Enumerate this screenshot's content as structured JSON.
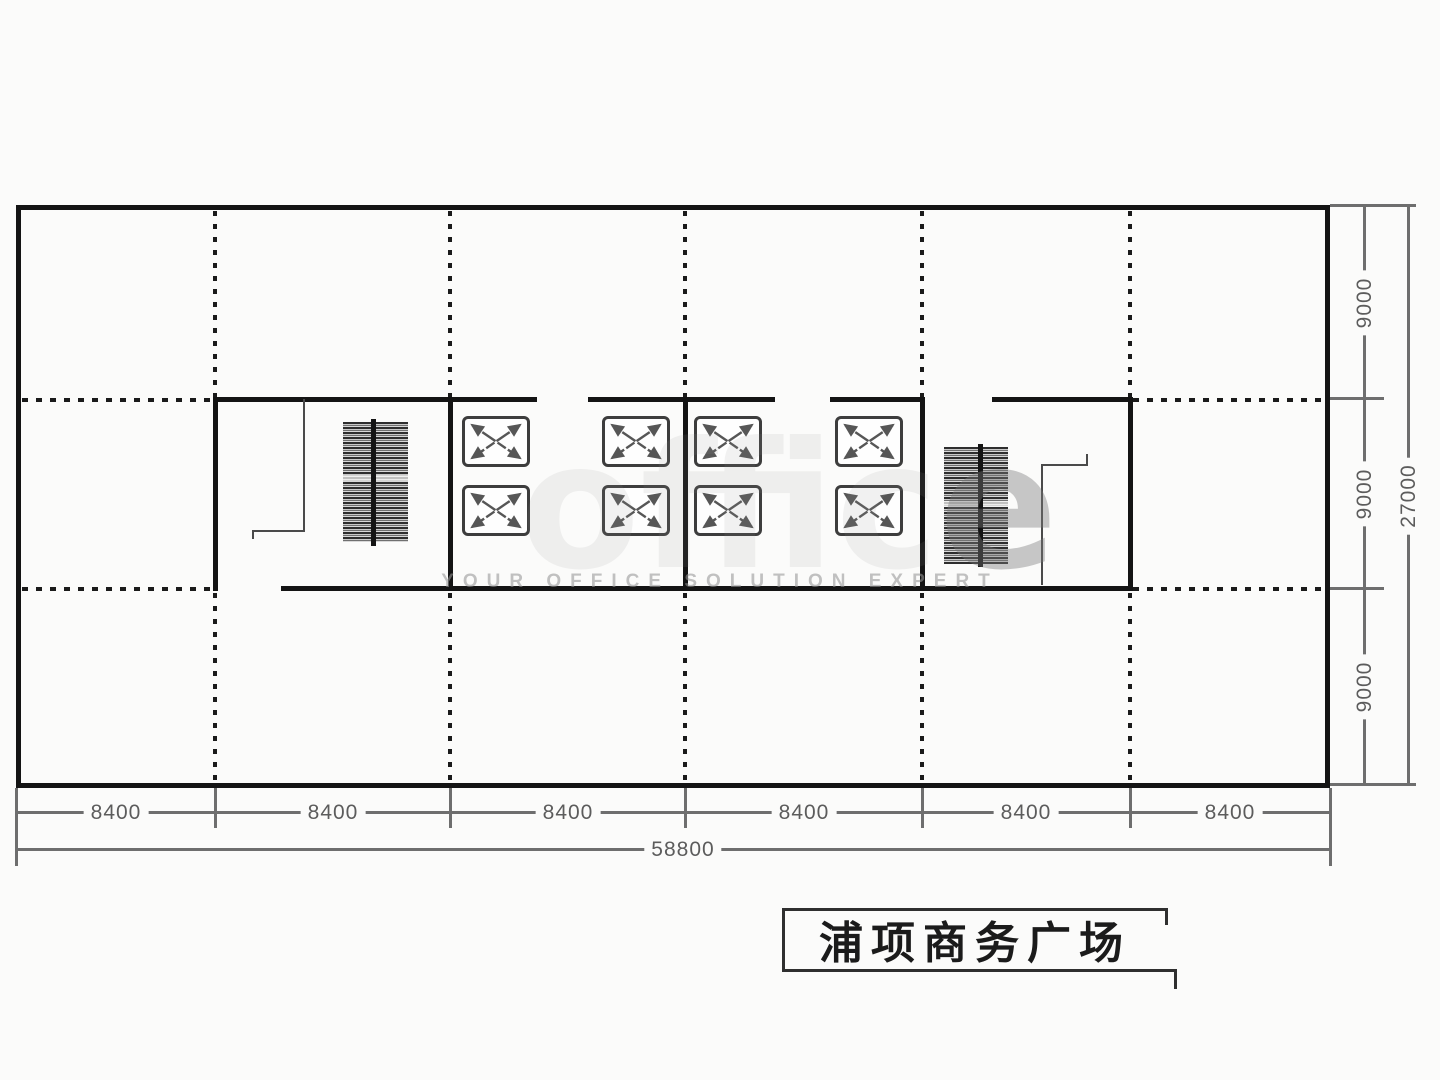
{
  "drawing": {
    "title": "浦项商务广场",
    "dimensions": {
      "bottom_bays": [
        "8400",
        "8400",
        "8400",
        "8400",
        "8400",
        "8400"
      ],
      "bottom_total": "58800",
      "right_bays": [
        "9000",
        "9000",
        "9000"
      ],
      "right_total": "27000"
    },
    "watermark": {
      "big_prefix": "offic",
      "big_emphasis": "e",
      "tagline": "YOUR OFFICE SOLUTION EXPERT"
    },
    "colors": {
      "wall": "#141414",
      "grid_line": "#1a1a1a",
      "dimension_line": "#6e6e6e",
      "dimension_text": "#5c5c5c",
      "title_text": "#1b1b1b",
      "paper": "#fbfbfa"
    }
  }
}
